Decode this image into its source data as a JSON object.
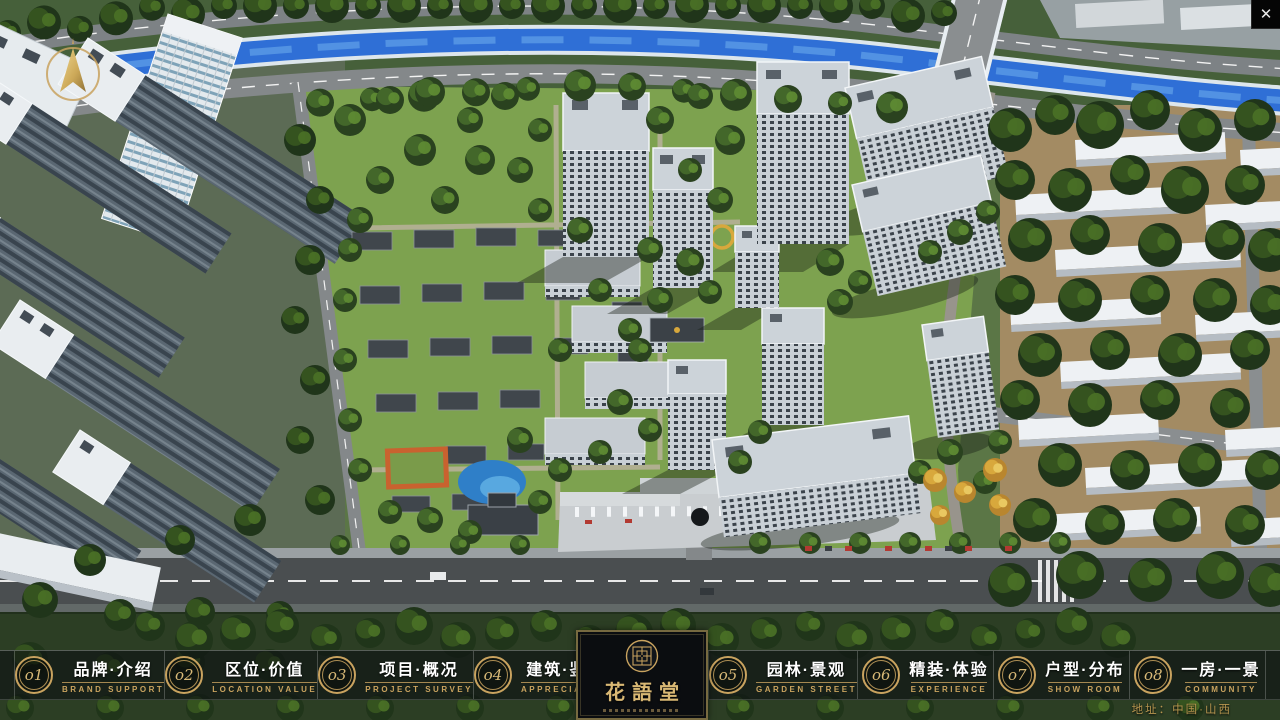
{
  "header": {
    "close_icon": "✕"
  },
  "logo": {
    "title": "花語堂"
  },
  "nav": {
    "items": [
      {
        "num": "o1",
        "zh": "品牌·介绍",
        "en": "BRAND SUPPORT"
      },
      {
        "num": "o2",
        "zh": "区位·价值",
        "en": "LOCATION VALUE"
      },
      {
        "num": "o3",
        "zh": "项目·概况",
        "en": "PROJECT SURVEY"
      },
      {
        "num": "o4",
        "zh": "建筑·鉴赏",
        "en": "APPRECIATION"
      },
      {
        "num": "o5",
        "zh": "园林·景观",
        "en": "GARDEN STREET"
      },
      {
        "num": "o6",
        "zh": "精装·体验",
        "en": "EXPERIENCE"
      },
      {
        "num": "o7",
        "zh": "户型·分布",
        "en": "SHOW ROOM"
      },
      {
        "num": "o8",
        "zh": "一房·一景",
        "en": "COMMUNITY"
      }
    ]
  },
  "footer": {
    "address": "地址：中国·山西"
  },
  "colors": {
    "gold": "#c9a35f",
    "gold_bright": "#d8b977",
    "bar_bg": "rgba(13,16,20,0.62)"
  }
}
